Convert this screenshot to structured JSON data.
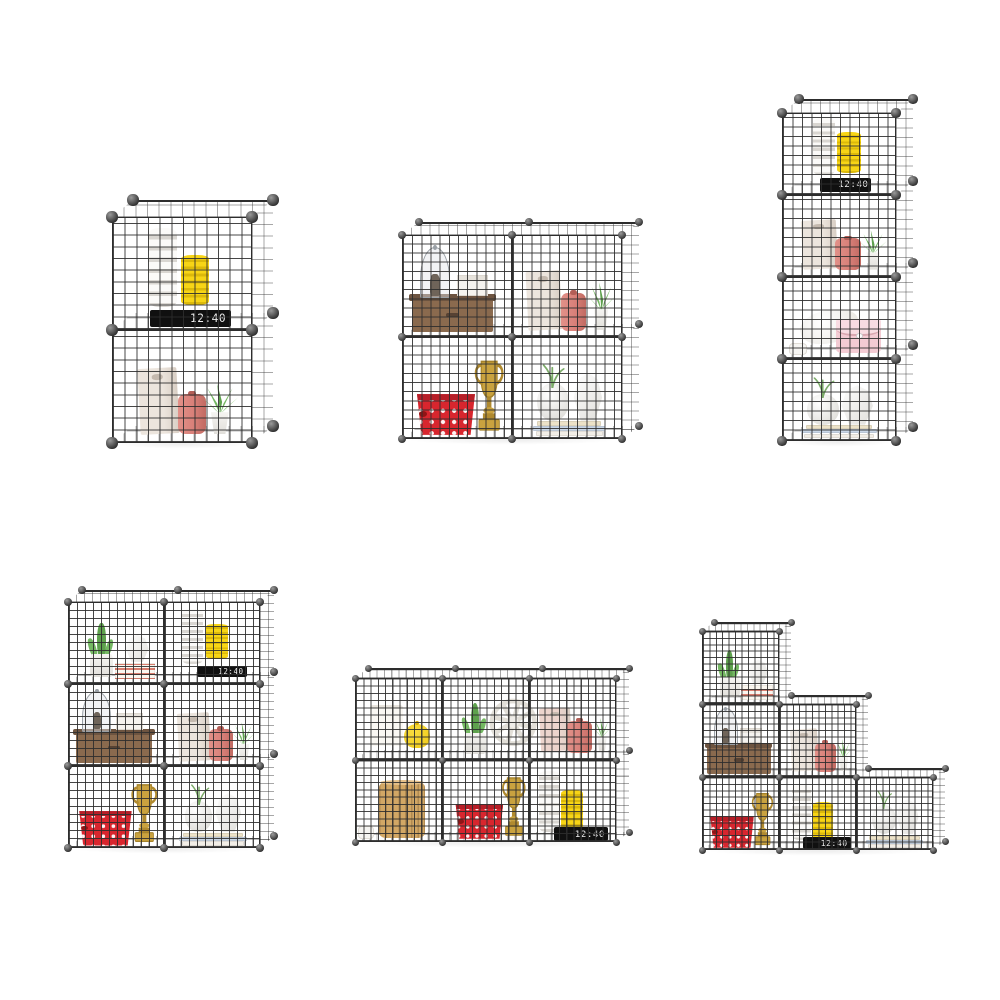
{
  "page": {
    "width": 1000,
    "height": 1000,
    "background": "#ffffff"
  },
  "clock_display": "12:40",
  "style": {
    "wire_solid": "#2d2d2d",
    "wire_front": "rgba(45,45,45,0.88)",
    "wire_face": "rgba(45,45,45,0.42)",
    "wire_floor": "rgba(45,45,45,0.32)",
    "connector_hi": "#9a9a9a",
    "connector_lo": "#2f2f2f",
    "mesh_squares_per_cube": 12,
    "shadow": "rgba(0,0,0,0.07)"
  },
  "item_colors": {
    "white_light": "#fbfaf8",
    "white_dark": "#d9d6d1",
    "yellow_light": "#f7d516",
    "yellow_dark": "#dcb90a",
    "clock_bg": "#101010",
    "clock_text": "#ededed",
    "bag_beige": "#ece5dd",
    "bag_shade": "#d8cec4",
    "bag_pink": "#ecd4cd",
    "bag_slot": "#c4b9ae",
    "canister": "#d98079",
    "canister_dark": "#c16a62",
    "canister_cap": "#b35e57",
    "green_a": "#74b862",
    "green_b": "#5ea14d",
    "green_c": "#8bc97a",
    "pot_white": "#f6f5f2",
    "pot_shade": "#e1dfda",
    "cloche_glass": "rgba(226,229,233,0.45)",
    "cloche_frame": "#9aa0a6",
    "figure": "#6f6459",
    "wood": "#8a6a4e",
    "wood_dark": "#6d5440",
    "wood_slot": "#574233",
    "box_white": "#f5f3ef",
    "box_lid": "#e6e2db",
    "box_edge": "#dcd7cf",
    "basket_red": "#d8262e",
    "basket_rim": "#b71e27",
    "basket_knob": "#8f1516",
    "gold": "#c9a23f",
    "gold_dark": "#a5822a",
    "gold_mid": "#b08a2f",
    "vase_hi": "#ffffff",
    "vase_lo": "#e0dfdb",
    "book_1": "#f2eee7",
    "book_2": "#c9d6e6",
    "book_3": "#ece2c8",
    "purse": "#f3cbd3",
    "purse_flap": "#f8dce2",
    "purse_line": "#d9a7b0",
    "pillow": "#eceae5",
    "candle": "#faf8f3",
    "candle_top": "#e9e5de",
    "jar": "#f0ca16",
    "jar_hi": "#f9dd3f",
    "jar_dark": "#d8ae04",
    "barrel": "#d2a765",
    "barrel_line": "rgba(101,72,35,0.3)",
    "barrel_top": "#e5c089",
    "wheel": "#e2dfd8",
    "wheel_hub": "#efede9",
    "stripe_red": "#d97d6e",
    "stripe_bg": "#faf6ef",
    "cup": "#f6f5f2",
    "cup_edge": "#e0dcd5",
    "sprig": "#7bab68"
  },
  "units": [
    {
      "name": "two-cube-tower",
      "x": 112,
      "y": 217,
      "cols": 1,
      "rows": 2,
      "cw": 140,
      "ch": 113,
      "cells": [
        {
          "col": 0,
          "row": 0,
          "items": [
            {
              "t": "spiral",
              "v": "white",
              "x": 0.36,
              "y": 0.2,
              "w": 0.21,
              "h": 0.7
            },
            {
              "t": "spiral",
              "v": "yellow",
              "x": 0.59,
              "y": 0.22,
              "w": 0.2,
              "h": 0.44
            },
            {
              "t": "clock",
              "x": 0.56,
              "y": 0.03,
              "w": 0.58,
              "h": 0.15
            }
          ]
        },
        {
          "col": 0,
          "row": 1,
          "items": [
            {
              "t": "bag",
              "v": "beige",
              "x": 0.33,
              "y": 0.08,
              "w": 0.28,
              "h": 0.58
            },
            {
              "t": "canister",
              "x": 0.57,
              "y": 0.08,
              "w": 0.2,
              "h": 0.35
            },
            {
              "t": "aloe",
              "x": 0.77,
              "y": 0.08,
              "w": 0.3,
              "h": 0.46
            }
          ]
        }
      ]
    },
    {
      "name": "two-by-two",
      "x": 402,
      "y": 235,
      "cols": 2,
      "rows": 2,
      "cw": 110,
      "ch": 102,
      "cells": [
        {
          "col": 0,
          "row": 0,
          "items": [
            {
              "t": "woodbox",
              "x": 0.46,
              "y": 0.05,
              "w": 0.74,
              "h": 0.34
            },
            {
              "t": "cloche",
              "x": 0.3,
              "y": 0.38,
              "w": 0.28,
              "h": 0.5
            },
            {
              "t": "whitebox",
              "x": 0.64,
              "y": 0.4,
              "w": 0.28,
              "h": 0.21
            }
          ]
        },
        {
          "col": 1,
          "row": 0,
          "items": [
            {
              "t": "bag",
              "v": "beige",
              "x": 0.29,
              "y": 0.07,
              "w": 0.31,
              "h": 0.58
            },
            {
              "t": "canister",
              "x": 0.56,
              "y": 0.06,
              "w": 0.23,
              "h": 0.37
            },
            {
              "t": "aloe",
              "x": 0.81,
              "y": 0.07,
              "w": 0.3,
              "h": 0.48
            }
          ]
        },
        {
          "col": 0,
          "row": 1,
          "items": [
            {
              "t": "basket",
              "x": 0.4,
              "y": 0.04,
              "w": 0.56,
              "h": 0.4
            },
            {
              "t": "trophy",
              "x": 0.79,
              "y": 0.05,
              "w": 0.33,
              "h": 0.74
            }
          ]
        },
        {
          "col": 1,
          "row": 1,
          "items": [
            {
              "t": "books",
              "x": 0.52,
              "y": 0.03,
              "w": 0.66,
              "h": 0.15
            },
            {
              "t": "vase_round",
              "x": 0.37,
              "y": 0.18,
              "w": 0.29,
              "h": 0.37
            },
            {
              "t": "sprig",
              "x": 0.37,
              "y": 0.5,
              "w": 0.26,
              "h": 0.24
            },
            {
              "t": "vase_geo",
              "x": 0.69,
              "y": 0.18,
              "w": 0.28,
              "h": 0.47
            }
          ]
        }
      ]
    },
    {
      "name": "four-cube-tower",
      "x": 782,
      "y": 113,
      "cols": 1,
      "rows": 4,
      "cw": 114,
      "ch": 82,
      "cells": [
        {
          "col": 0,
          "row": 0,
          "items": [
            {
              "t": "spiral",
              "v": "white",
              "x": 0.37,
              "y": 0.24,
              "w": 0.19,
              "h": 0.7
            },
            {
              "t": "spiral",
              "v": "yellow",
              "x": 0.59,
              "y": 0.27,
              "w": 0.21,
              "h": 0.5
            },
            {
              "t": "clock",
              "x": 0.56,
              "y": 0.04,
              "w": 0.45,
              "h": 0.17
            }
          ]
        },
        {
          "col": 0,
          "row": 1,
          "items": [
            {
              "t": "bag",
              "v": "beige",
              "x": 0.33,
              "y": 0.09,
              "w": 0.31,
              "h": 0.6
            },
            {
              "t": "canister",
              "x": 0.58,
              "y": 0.08,
              "w": 0.23,
              "h": 0.39
            },
            {
              "t": "aloe",
              "x": 0.8,
              "y": 0.09,
              "w": 0.28,
              "h": 0.5
            }
          ]
        },
        {
          "col": 0,
          "row": 2,
          "items": [
            {
              "t": "cup",
              "x": 0.14,
              "y": 0.05,
              "w": 0.16,
              "h": 0.14
            },
            {
              "t": "pillow",
              "x": 0.42,
              "y": 0.2,
              "w": 0.52,
              "h": 0.4
            },
            {
              "t": "purse",
              "x": 0.67,
              "y": 0.07,
              "w": 0.4,
              "h": 0.42
            }
          ]
        },
        {
          "col": 0,
          "row": 3,
          "items": [
            {
              "t": "books",
              "x": 0.5,
              "y": 0.04,
              "w": 0.66,
              "h": 0.16
            },
            {
              "t": "vase_round",
              "x": 0.36,
              "y": 0.2,
              "w": 0.28,
              "h": 0.37
            },
            {
              "t": "sprig",
              "x": 0.36,
              "y": 0.52,
              "w": 0.24,
              "h": 0.26
            },
            {
              "t": "vase_geo",
              "x": 0.66,
              "y": 0.2,
              "w": 0.3,
              "h": 0.48
            }
          ]
        }
      ]
    },
    {
      "name": "two-by-three",
      "x": 68,
      "y": 602,
      "cols": 2,
      "rows": 3,
      "cw": 96,
      "ch": 82,
      "cells": [
        {
          "col": 0,
          "row": 0,
          "items": [
            {
              "t": "cactus",
              "x": 0.35,
              "y": 0.09,
              "w": 0.38,
              "h": 0.76
            },
            {
              "t": "stripedbooks",
              "x": 0.7,
              "y": 0.06,
              "w": 0.42,
              "h": 0.2
            },
            {
              "t": "vase_geo",
              "x": 0.72,
              "y": 0.27,
              "w": 0.26,
              "h": 0.33
            }
          ]
        },
        {
          "col": 1,
          "row": 0,
          "items": [
            {
              "t": "spiral",
              "v": "white",
              "x": 0.3,
              "y": 0.24,
              "w": 0.22,
              "h": 0.68
            },
            {
              "t": "spiral",
              "v": "yellow",
              "x": 0.55,
              "y": 0.3,
              "w": 0.23,
              "h": 0.43
            },
            {
              "t": "clock",
              "x": 0.6,
              "y": 0.08,
              "w": 0.52,
              "h": 0.14
            }
          ]
        },
        {
          "col": 0,
          "row": 1,
          "items": [
            {
              "t": "woodbox",
              "x": 0.48,
              "y": 0.04,
              "w": 0.8,
              "h": 0.38
            },
            {
              "t": "cloche",
              "x": 0.3,
              "y": 0.42,
              "w": 0.3,
              "h": 0.5
            },
            {
              "t": "whitebox",
              "x": 0.64,
              "y": 0.44,
              "w": 0.29,
              "h": 0.21
            }
          ]
        },
        {
          "col": 1,
          "row": 1,
          "items": [
            {
              "t": "bag",
              "v": "beige",
              "x": 0.31,
              "y": 0.07,
              "w": 0.33,
              "h": 0.58
            },
            {
              "t": "canister",
              "x": 0.59,
              "y": 0.06,
              "w": 0.25,
              "h": 0.39
            },
            {
              "t": "aloe",
              "x": 0.83,
              "y": 0.07,
              "w": 0.28,
              "h": 0.48
            }
          ]
        },
        {
          "col": 0,
          "row": 2,
          "items": [
            {
              "t": "basket",
              "x": 0.39,
              "y": 0.03,
              "w": 0.58,
              "h": 0.42
            },
            {
              "t": "trophy",
              "x": 0.79,
              "y": 0.04,
              "w": 0.34,
              "h": 0.76
            }
          ]
        },
        {
          "col": 1,
          "row": 2,
          "items": [
            {
              "t": "books",
              "x": 0.51,
              "y": 0.03,
              "w": 0.7,
              "h": 0.16
            },
            {
              "t": "vase_round",
              "x": 0.36,
              "y": 0.2,
              "w": 0.29,
              "h": 0.37
            },
            {
              "t": "sprig",
              "x": 0.36,
              "y": 0.52,
              "w": 0.25,
              "h": 0.26
            },
            {
              "t": "vase_geo",
              "x": 0.67,
              "y": 0.2,
              "w": 0.29,
              "h": 0.47
            }
          ]
        }
      ]
    },
    {
      "name": "three-by-two",
      "x": 355,
      "y": 678,
      "cols": 3,
      "rows": 2,
      "cw": 87,
      "ch": 82,
      "cells": [
        {
          "col": 0,
          "row": 0,
          "items": [
            {
              "t": "candle",
              "x": 0.36,
              "y": 0.17,
              "w": 0.38,
              "h": 0.5
            },
            {
              "t": "jaryellow",
              "x": 0.71,
              "y": 0.15,
              "w": 0.3,
              "h": 0.33
            }
          ]
        },
        {
          "col": 1,
          "row": 0,
          "items": [
            {
              "t": "cactus",
              "x": 0.38,
              "y": 0.07,
              "w": 0.4,
              "h": 0.73
            },
            {
              "t": "wheel",
              "x": 0.82,
              "y": 0.09,
              "w": 0.58,
              "h": 0.74
            }
          ]
        },
        {
          "col": 2,
          "row": 0,
          "items": [
            {
              "t": "bag",
              "v": "pink",
              "x": 0.31,
              "y": 0.11,
              "w": 0.36,
              "h": 0.52
            },
            {
              "t": "canister",
              "x": 0.58,
              "y": 0.09,
              "w": 0.28,
              "h": 0.39
            },
            {
              "t": "aloe",
              "x": 0.84,
              "y": 0.11,
              "w": 0.25,
              "h": 0.41
            }
          ]
        },
        {
          "col": 0,
          "row": 1,
          "items": [
            {
              "t": "cup",
              "x": 0.13,
              "y": 0.04,
              "w": 0.18,
              "h": 0.15
            },
            {
              "t": "barrel",
              "x": 0.54,
              "y": 0.05,
              "w": 0.52,
              "h": 0.68
            }
          ]
        },
        {
          "col": 1,
          "row": 1,
          "items": [
            {
              "t": "basket",
              "x": 0.43,
              "y": 0.04,
              "w": 0.58,
              "h": 0.42
            },
            {
              "t": "trophy",
              "x": 0.83,
              "y": 0.05,
              "w": 0.34,
              "h": 0.77
            }
          ]
        },
        {
          "col": 2,
          "row": 1,
          "items": [
            {
              "t": "spiral",
              "v": "white",
              "x": 0.24,
              "y": 0.12,
              "w": 0.24,
              "h": 0.75
            },
            {
              "t": "spiral",
              "v": "yellow",
              "x": 0.49,
              "y": 0.12,
              "w": 0.25,
              "h": 0.52
            },
            {
              "t": "clock",
              "x": 0.6,
              "y": 0.01,
              "w": 0.62,
              "h": 0.17
            }
          ]
        }
      ]
    },
    {
      "name": "staircase",
      "x": 702,
      "y": 631,
      "cols": 3,
      "rows": 3,
      "cw": 77,
      "ch": 73,
      "cells": [
        {
          "col": 0,
          "row": 0,
          "items": [
            {
              "t": "cactus",
              "x": 0.36,
              "y": 0.09,
              "w": 0.4,
              "h": 0.76
            },
            {
              "t": "stripedbooks",
              "x": 0.71,
              "y": 0.06,
              "w": 0.42,
              "h": 0.2
            },
            {
              "t": "vase_geo",
              "x": 0.73,
              "y": 0.27,
              "w": 0.27,
              "h": 0.34
            }
          ]
        },
        {
          "col": 0,
          "row": 1,
          "items": [
            {
              "t": "woodbox",
              "x": 0.48,
              "y": 0.04,
              "w": 0.82,
              "h": 0.4
            },
            {
              "t": "cloche",
              "x": 0.31,
              "y": 0.44,
              "w": 0.31,
              "h": 0.5
            },
            {
              "t": "whitebox",
              "x": 0.64,
              "y": 0.46,
              "w": 0.29,
              "h": 0.21
            }
          ]
        },
        {
          "col": 1,
          "row": 1,
          "items": [
            {
              "t": "bag",
              "v": "beige",
              "x": 0.33,
              "y": 0.08,
              "w": 0.35,
              "h": 0.58
            },
            {
              "t": "canister",
              "x": 0.6,
              "y": 0.07,
              "w": 0.27,
              "h": 0.4
            },
            {
              "t": "aloe",
              "x": 0.84,
              "y": 0.08,
              "w": 0.27,
              "h": 0.46
            }
          ]
        },
        {
          "col": 0,
          "row": 2,
          "items": [
            {
              "t": "basket",
              "x": 0.39,
              "y": 0.03,
              "w": 0.6,
              "h": 0.43
            },
            {
              "t": "trophy",
              "x": 0.78,
              "y": 0.04,
              "w": 0.35,
              "h": 0.77
            }
          ]
        },
        {
          "col": 1,
          "row": 2,
          "items": [
            {
              "t": "spiral",
              "v": "white",
              "x": 0.29,
              "y": 0.13,
              "w": 0.25,
              "h": 0.76
            },
            {
              "t": "spiral",
              "v": "yellow",
              "x": 0.57,
              "y": 0.14,
              "w": 0.26,
              "h": 0.52
            },
            {
              "t": "clock",
              "x": 0.62,
              "y": 0.01,
              "w": 0.62,
              "h": 0.17
            }
          ]
        },
        {
          "col": 2,
          "row": 2,
          "items": [
            {
              "t": "books",
              "x": 0.5,
              "y": 0.03,
              "w": 0.74,
              "h": 0.17
            },
            {
              "t": "vase_round",
              "x": 0.36,
              "y": 0.22,
              "w": 0.31,
              "h": 0.39
            },
            {
              "t": "sprig",
              "x": 0.36,
              "y": 0.56,
              "w": 0.25,
              "h": 0.26
            },
            {
              "t": "vase_geo",
              "x": 0.67,
              "y": 0.22,
              "w": 0.31,
              "h": 0.48
            }
          ]
        }
      ]
    }
  ]
}
